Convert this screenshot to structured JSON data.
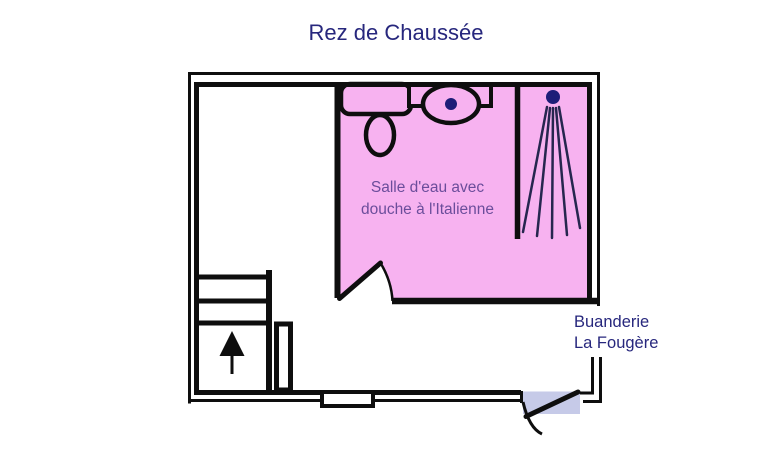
{
  "title": "Rez de Chaussée",
  "bathroom": {
    "label_line1": "Salle d'eau avec",
    "label_line2": "douche à l'Italienne"
  },
  "building": {
    "label_line1": "Buanderie",
    "label_line2": "La Fougère"
  },
  "fixtures": {
    "vanity": "vanity-counter",
    "toilet": "toilet",
    "washbasin": "washbasin-with-drain",
    "shower": "shower-head-with-spray",
    "stairs": "staircase-up",
    "entrance": "entrance-door-with-swing",
    "window": "bottom-wall-window"
  },
  "colors": {
    "background": "#ffffff",
    "wall": "#0e0e0e",
    "room_fill": "#f7b2f0",
    "title_text": "#27277d",
    "building_label_text": "#27277d",
    "bathroom_label_text": "#6b4d9b",
    "fixture_dot": "#1d1d78",
    "spray_line": "#26264f",
    "door_panel": "#c6cae8"
  }
}
